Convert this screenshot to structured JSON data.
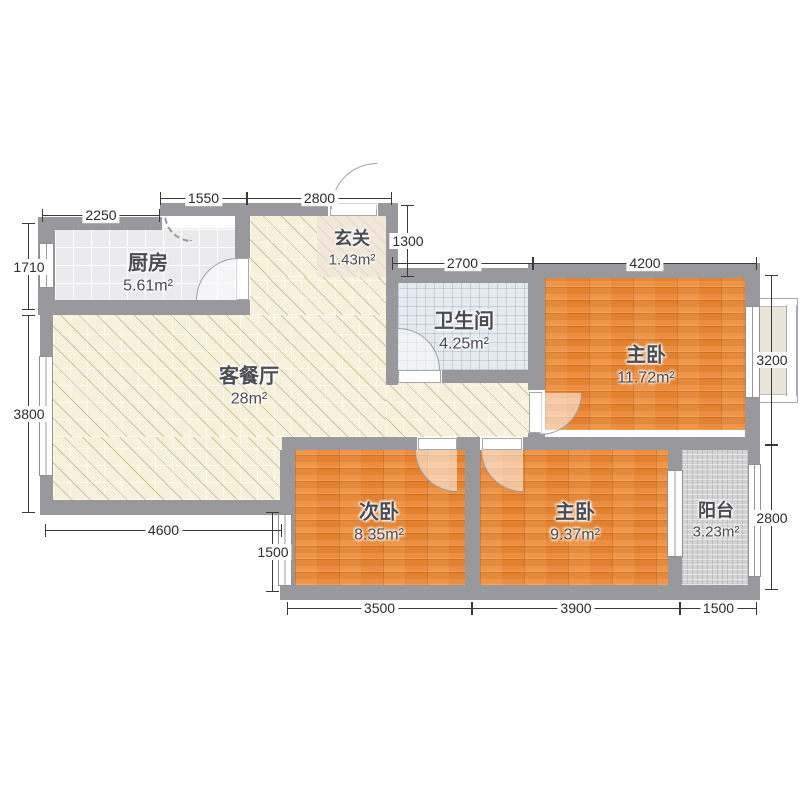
{
  "rooms": {
    "kitchen": {
      "name": "厨房",
      "area": "5.61m²"
    },
    "entry": {
      "name": "玄关",
      "area": "1.43m²"
    },
    "living": {
      "name": "客餐厅",
      "area": "28m²"
    },
    "bathroom": {
      "name": "卫生间",
      "area": "4.25m²"
    },
    "master_top": {
      "name": "主卧",
      "area": "11.72m²"
    },
    "second": {
      "name": "次卧",
      "area": "8.35m²"
    },
    "master_bottom": {
      "name": "主卧",
      "area": "9.37m²"
    },
    "balcony": {
      "name": "阳台",
      "area": "3.23m²"
    }
  },
  "dimensions": {
    "top_kitchen": "2250",
    "top_mid": "1550",
    "top_entry": "2800",
    "top_bath": "2700",
    "top_master": "4200",
    "left_kitchen": "1710",
    "left_living": "3800",
    "entry_depth": "1300",
    "right_master": "3200",
    "right_balcony": "2800",
    "bottom_living": "4600",
    "side_second": "1500",
    "bottom_second": "3500",
    "bottom_master": "3900",
    "bottom_balcony": "1500"
  },
  "colors": {
    "wall": "#98989d",
    "wood_floor": "#e8883c",
    "living_floor": "#f7f1db",
    "kitchen_floor": "#ebebee",
    "bath_floor": "#e4eaee",
    "balcony_floor": "#d3d3d3",
    "dim_line": "#3a3a3a",
    "label_text": "#4b4b52"
  }
}
